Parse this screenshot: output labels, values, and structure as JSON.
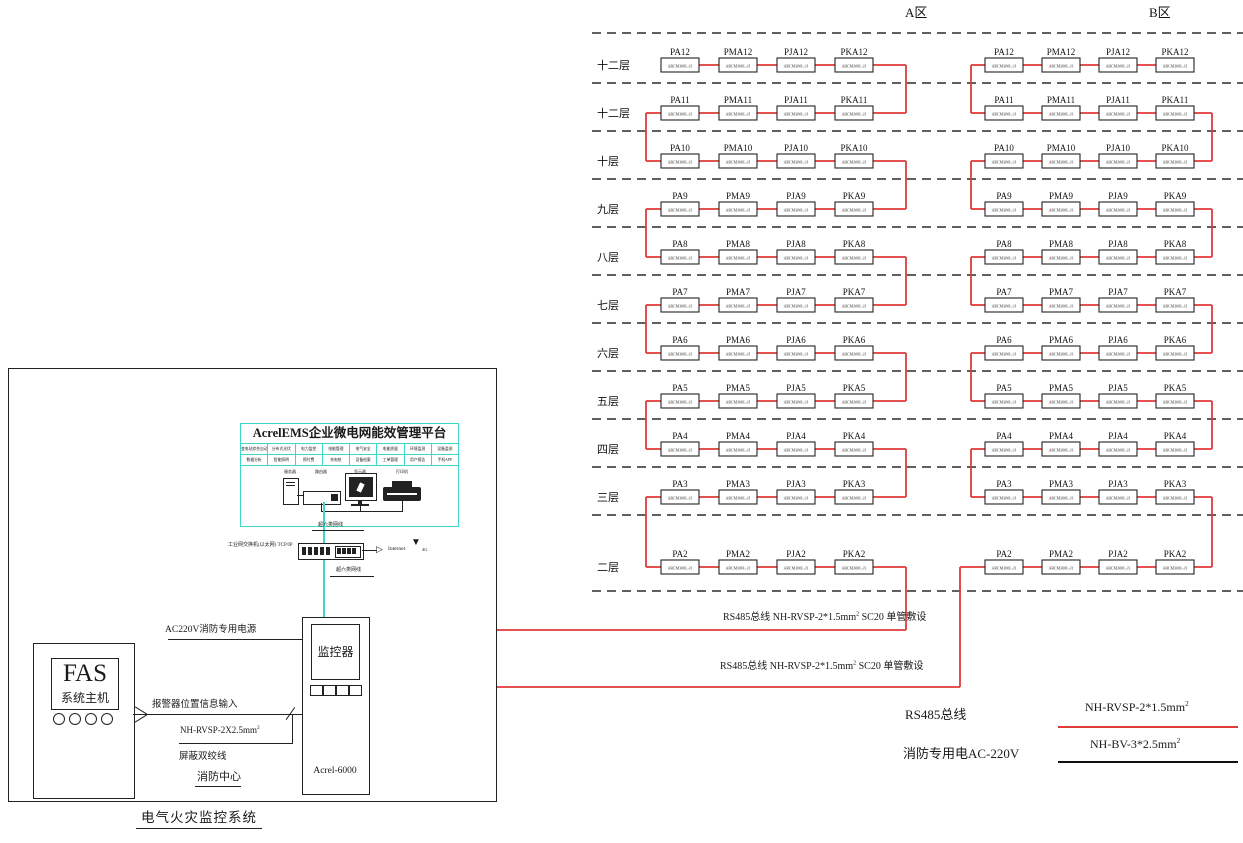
{
  "footer": {
    "title": "电气火灾监控系统"
  },
  "zones": [
    {
      "name": "A区",
      "columns": [
        "PA",
        "PMA",
        "PJA",
        "PKA"
      ]
    },
    {
      "name": "B区",
      "columns": [
        "PA",
        "PMA",
        "PJA",
        "PKA"
      ]
    }
  ],
  "floors": [
    {
      "label": "十二层",
      "num": "12"
    },
    {
      "label": "十二层",
      "num": "11"
    },
    {
      "label": "十层",
      "num": "10"
    },
    {
      "label": "九层",
      "num": "9"
    },
    {
      "label": "八层",
      "num": "8"
    },
    {
      "label": "七层",
      "num": "7"
    },
    {
      "label": "六层",
      "num": "6"
    },
    {
      "label": "五层",
      "num": "5"
    },
    {
      "label": "四层",
      "num": "4"
    },
    {
      "label": "三层",
      "num": "3"
    },
    {
      "label": "二层",
      "num": "2"
    }
  ],
  "device_model": "ARCM300L-J1",
  "platform": {
    "title": "AcrelEMS企业微电网能效管理平台",
    "features": [
      [
        "变电站综合自动化",
        "分布式光伏",
        "电力监控",
        "电能管理",
        "电气安全",
        "电能质量",
        "环境监测",
        "设备监测"
      ],
      [
        "数据分析",
        "智能照明",
        "预付费",
        "充电桩",
        "设备档案",
        "工单管理",
        "用户报告",
        "手机APP"
      ]
    ],
    "devices": [
      "服务器",
      "路由器",
      "显示器",
      "打印机"
    ]
  },
  "network": {
    "switch_label": "工业网交换机(以太网) TCP/IP",
    "cable_label": "超六类网线",
    "internet": "Internet",
    "wireless": "4G"
  },
  "cabinet": {
    "screen": "监控器",
    "model": "Acrel-6000"
  },
  "fas": {
    "title": "FAS",
    "subtitle": "系统主机"
  },
  "connections": {
    "power": "AC220V消防专用电源",
    "alarm": "报警器位置信息输入",
    "cable_spec": "NH-RVSP-2X2.5mm",
    "cable_spec_sup": "2",
    "shield": "屏蔽双绞线",
    "location": "消防中心"
  },
  "bus": {
    "label": "RS485总线 NH-RVSP-2*1.5mm",
    "sup": "2",
    "tail": " SC20 单管敷设"
  },
  "legend": {
    "rs485": "RS485总线",
    "power": "消防专用电AC-220V",
    "red_cable": "NH-RVSP-2*1.5mm",
    "red_sup": "2",
    "black_cable": "NH-BV-3*2.5mm",
    "black_sup": "2"
  },
  "colors": {
    "red": "#e03a3a",
    "cyan": "#3fd6c8",
    "line": "#1f1f1f"
  }
}
